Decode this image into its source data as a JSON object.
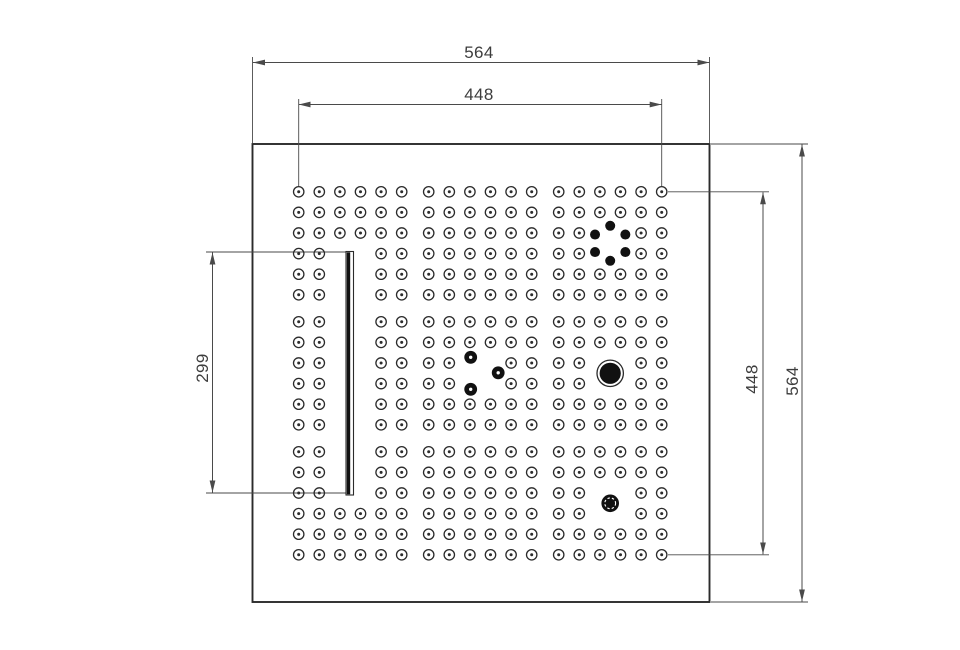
{
  "drawing_type": "technical-drawing-perforated-square-panel-top-view",
  "colors": {
    "background": "#ffffff",
    "outline": "#2b2b2b",
    "solid": "#111111",
    "dimension_lines": "#4a4a4a",
    "text": "#3d3d3d"
  },
  "dimensions": {
    "top_width": {
      "value": "564"
    },
    "top_hole_span": {
      "value": "448"
    },
    "left_slot_length": {
      "value": "299"
    },
    "right_hole_span": {
      "value": "448"
    },
    "right_height": {
      "value": "564"
    }
  },
  "plate": {
    "x": 252.5,
    "y": 144,
    "width": 457,
    "height": 458
  },
  "hole_grid": {
    "origin_x": 298.7,
    "origin_y": 191.8,
    "spacing": 20.6,
    "group_gap": 27,
    "per_group": 6,
    "groups": 3,
    "hole_radius": 5.2,
    "center_dot_radius": 1.5,
    "cleared_regions": [
      {
        "name": "slot-area",
        "cols": [
          2,
          3
        ],
        "rows": [
          3,
          14
        ]
      },
      {
        "name": "hex-cluster-area",
        "cols": [
          14,
          15
        ],
        "rows": [
          2,
          3
        ]
      },
      {
        "name": "dot-triangle-area",
        "cols": [
          8,
          9
        ],
        "rows": [
          8,
          9
        ]
      },
      {
        "name": "ring-circle-area",
        "cols": [
          14,
          15
        ],
        "rows": [
          8,
          9
        ]
      },
      {
        "name": "knurled-circle-area",
        "cols": [
          14,
          15
        ],
        "rows": [
          14,
          15
        ]
      }
    ]
  },
  "slot": {
    "x": 346,
    "y": 251.5,
    "width": 7.5,
    "height": 243.5,
    "bar_width": 3.4
  },
  "features": [
    {
      "name": "hex-bolt-cluster",
      "type": "hex_ring",
      "cols": [
        14,
        15
      ],
      "rows": [
        2,
        3
      ],
      "ring_radius": 17.5,
      "dot_radius": 5,
      "angles_deg": [
        270,
        330,
        30,
        90,
        150,
        210
      ]
    },
    {
      "name": "dot-triangle",
      "type": "dot_triangle",
      "cols": [
        8,
        9
      ],
      "rows": [
        8,
        9
      ],
      "dot_radius": 6.4,
      "pilot_radius": 1.7,
      "offsets": [
        [
          -9.5,
          -16
        ],
        [
          18,
          -0.5
        ],
        [
          -9.5,
          16
        ]
      ]
    },
    {
      "name": "large-ring-circle",
      "type": "ring_circle",
      "cols": [
        14,
        15
      ],
      "rows": [
        8,
        9
      ],
      "outer_radius": 13.2,
      "inner_radius": 10.6
    },
    {
      "name": "knurled-circle",
      "type": "knurled_circle",
      "cols": [
        14,
        15
      ],
      "rows": [
        14,
        15
      ],
      "radius": 8.8,
      "ring_radius": 5.4
    }
  ]
}
